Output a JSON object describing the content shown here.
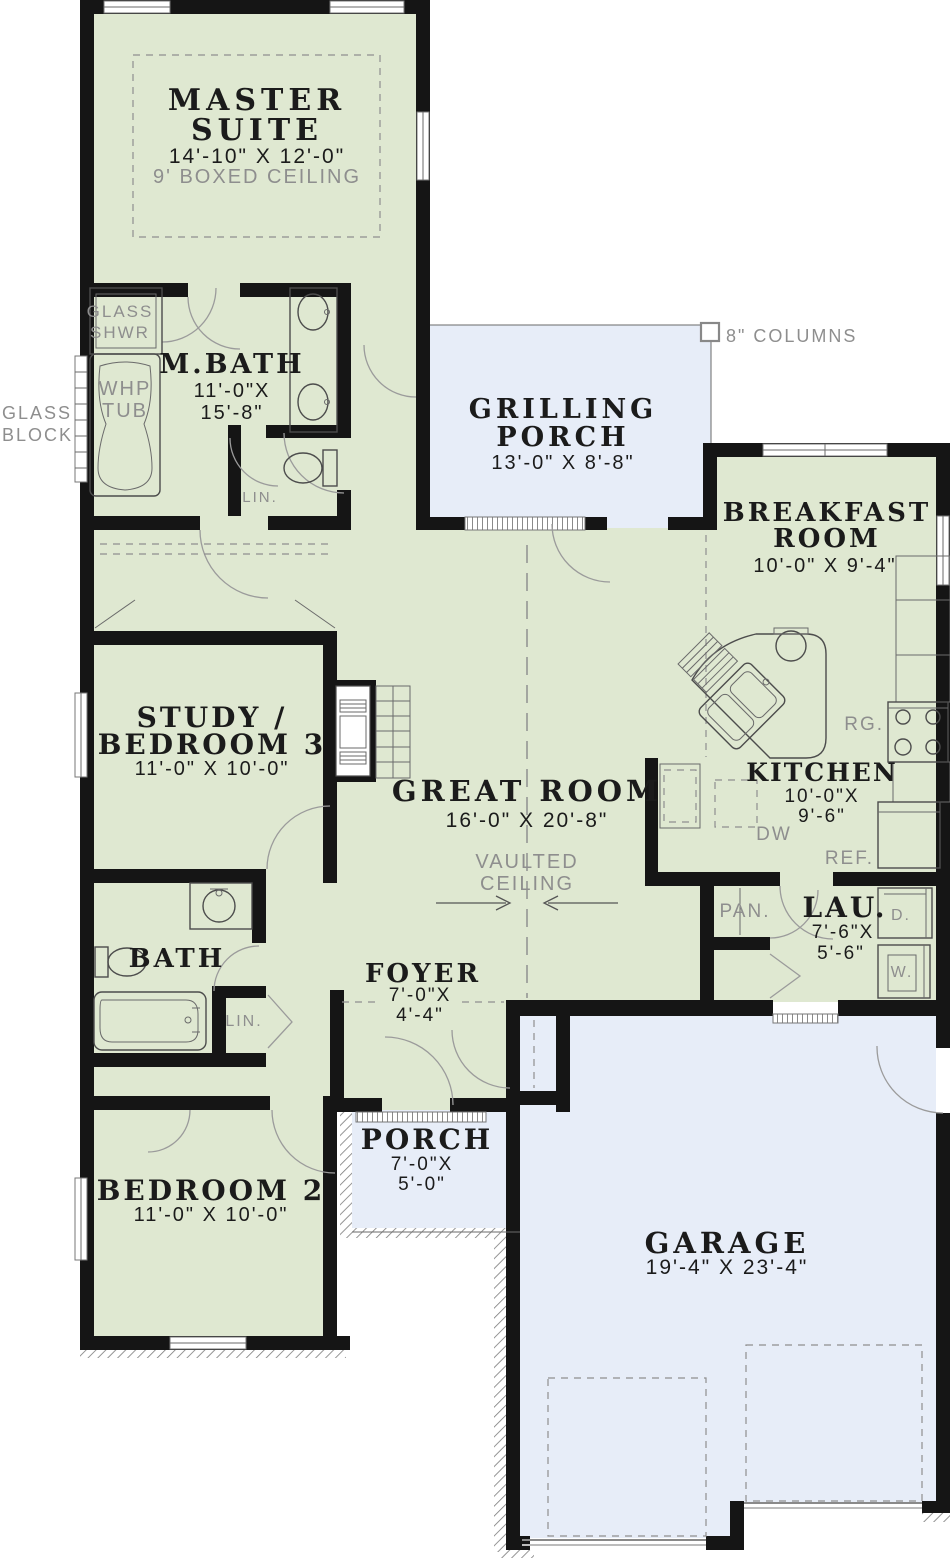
{
  "plan": {
    "rooms": {
      "master": {
        "l1": "MASTER",
        "l2": "SUITE",
        "dim": "14'-10\" X 12'-0\"",
        "note": "9' BOXED CEILING"
      },
      "mbath": {
        "name": "M.BATH",
        "dim1": "11'-0\"X",
        "dim2": "15'-8\""
      },
      "grilling_porch": {
        "l1": "GRILLING",
        "l2": "PORCH",
        "dim": "13'-0\" X 8'-8\""
      },
      "breakfast": {
        "l1": "BREAKFAST",
        "l2": "ROOM",
        "dim": "10'-0\" X 9'-4\""
      },
      "study": {
        "l1": "STUDY /",
        "l2": "BEDROOM 3",
        "dim": "11'-0\" X 10'-0\""
      },
      "great_room": {
        "name": "GREAT ROOM",
        "dim": "16'-0\" X 20'-8\"",
        "note1": "VAULTED",
        "note2": "CEILING"
      },
      "kitchen": {
        "name": "KITCHEN",
        "dim1": "10'-0\"X",
        "dim2": "9'-6\""
      },
      "bath": {
        "name": "BATH"
      },
      "laundry": {
        "name": "LAU.",
        "dim1": "7'-6\"X",
        "dim2": "5'-6\""
      },
      "foyer": {
        "name": "FOYER",
        "dim1": "7'-0\"X",
        "dim2": "4'-4\""
      },
      "bedroom2": {
        "name": "BEDROOM 2",
        "dim": "11'-0\" X 10'-0\""
      },
      "porch": {
        "name": "PORCH",
        "dim1": "7'-0\"X",
        "dim2": "5'-0\""
      },
      "garage": {
        "name": "GARAGE",
        "dim": "19'-4\" X 23'-4\""
      }
    },
    "labels": {
      "glass_shwr1": "GLASS",
      "glass_shwr2": "SHWR",
      "whp1": "WHP",
      "whp2": "TUB",
      "glass_block1": "GLASS",
      "glass_block2": "BLOCK",
      "lin_mbath": "LIN.",
      "lin_bath": "LIN.",
      "pantry": "PAN.",
      "dishwasher": "DW",
      "range": "RG.",
      "refrigerator": "REF.",
      "dryer": "D.",
      "washer": "W.",
      "columns": "8\" COLUMNS"
    },
    "colors": {
      "wall": "#151515",
      "room_fill": "#dfe8d1",
      "porch_fill": "#e7edf8",
      "annotation": "#8e8e8e",
      "dim_text": "#1b1b1b"
    }
  }
}
